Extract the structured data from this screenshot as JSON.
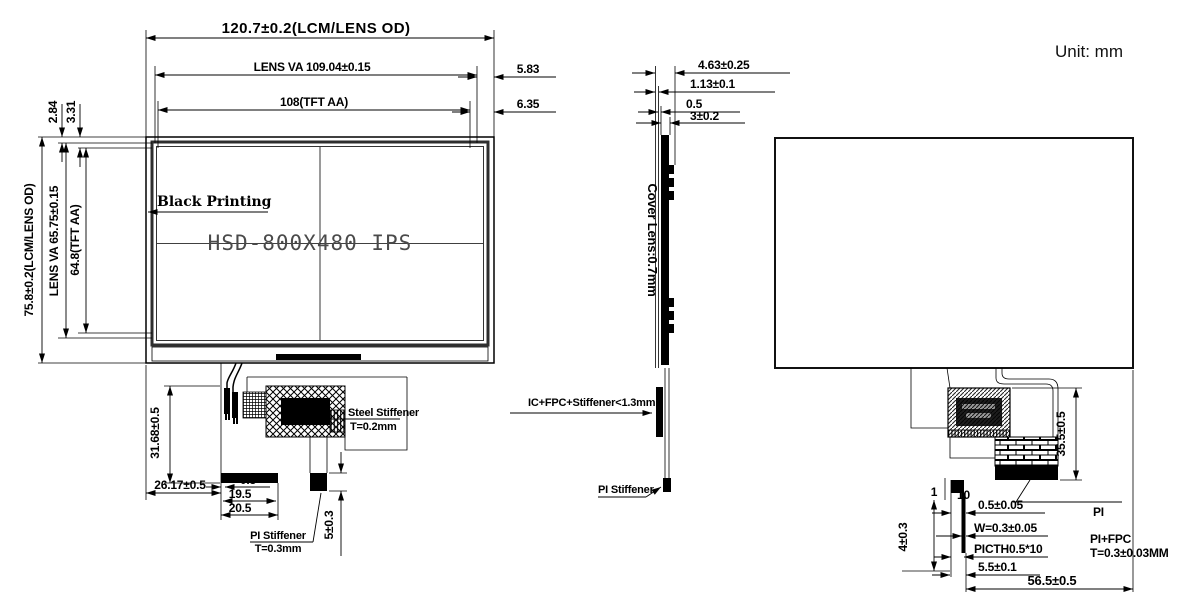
{
  "unit_label": "Unit: mm",
  "front_view": {
    "black_printing_label": "Black Printing",
    "panel_model": "HSD-800X480 IPS",
    "dims": {
      "width_od": "120.7±0.2(LCM/LENS OD)",
      "width_lens_va": "LENS VA 109.04±0.15",
      "width_tft_aa": "108(TFT AA)",
      "right_offset_va": "5.83",
      "right_offset_aa": "6.35",
      "top_offset_va": "2.84",
      "top_offset_aa": "3.31",
      "height_od": "75.8±0.2(LCM/LENS OD)",
      "height_lens_va": "LENS VA 65.75±0.15",
      "height_tft_aa": "64.8(TFT AA)"
    },
    "fpc": {
      "height": "31.68±0.5",
      "left_offset": "26.17±0.5",
      "contact_margin": "0.5",
      "contact_inner_width": "19.5",
      "contact_outer_width": "20.5",
      "steel_stiffener_label": "Steel Stiffener",
      "steel_stiffener_thickness": "T=0.2mm",
      "pi_stiffener_label": "PI Stiffener",
      "pi_stiffener_thickness": "T=0.3mm",
      "tail_height": "5±0.3"
    }
  },
  "side_view": {
    "cover_lens_label": "Cover Lens:0.7mm",
    "ic_label": "IC+FPC+Stiffener<1.3mm",
    "pi_stiffener_label": "PI Stiffener",
    "dims": {
      "total_thickness": "4.63±0.25",
      "lens_thickness": "1.13±0.1",
      "gap": "0.5",
      "module_thickness": "3±0.2"
    }
  },
  "rear_view": {
    "labels": {
      "pi": "PI",
      "pi_fpc": "PI+FPC",
      "pi_fpc_thickness": "T=0.3±0.03MM"
    },
    "dims": {
      "fpc_height": "35.5±0.5",
      "tail_gap": "1",
      "pin_count": "10",
      "contact_width": "0.5±0.05",
      "line_width": "W=0.3±0.05",
      "pitch": "PICTH0.5*10",
      "tail_width": "5.5±0.1",
      "fpc_offset": "56.5±0.5",
      "tail_length": "4±0.3"
    }
  }
}
